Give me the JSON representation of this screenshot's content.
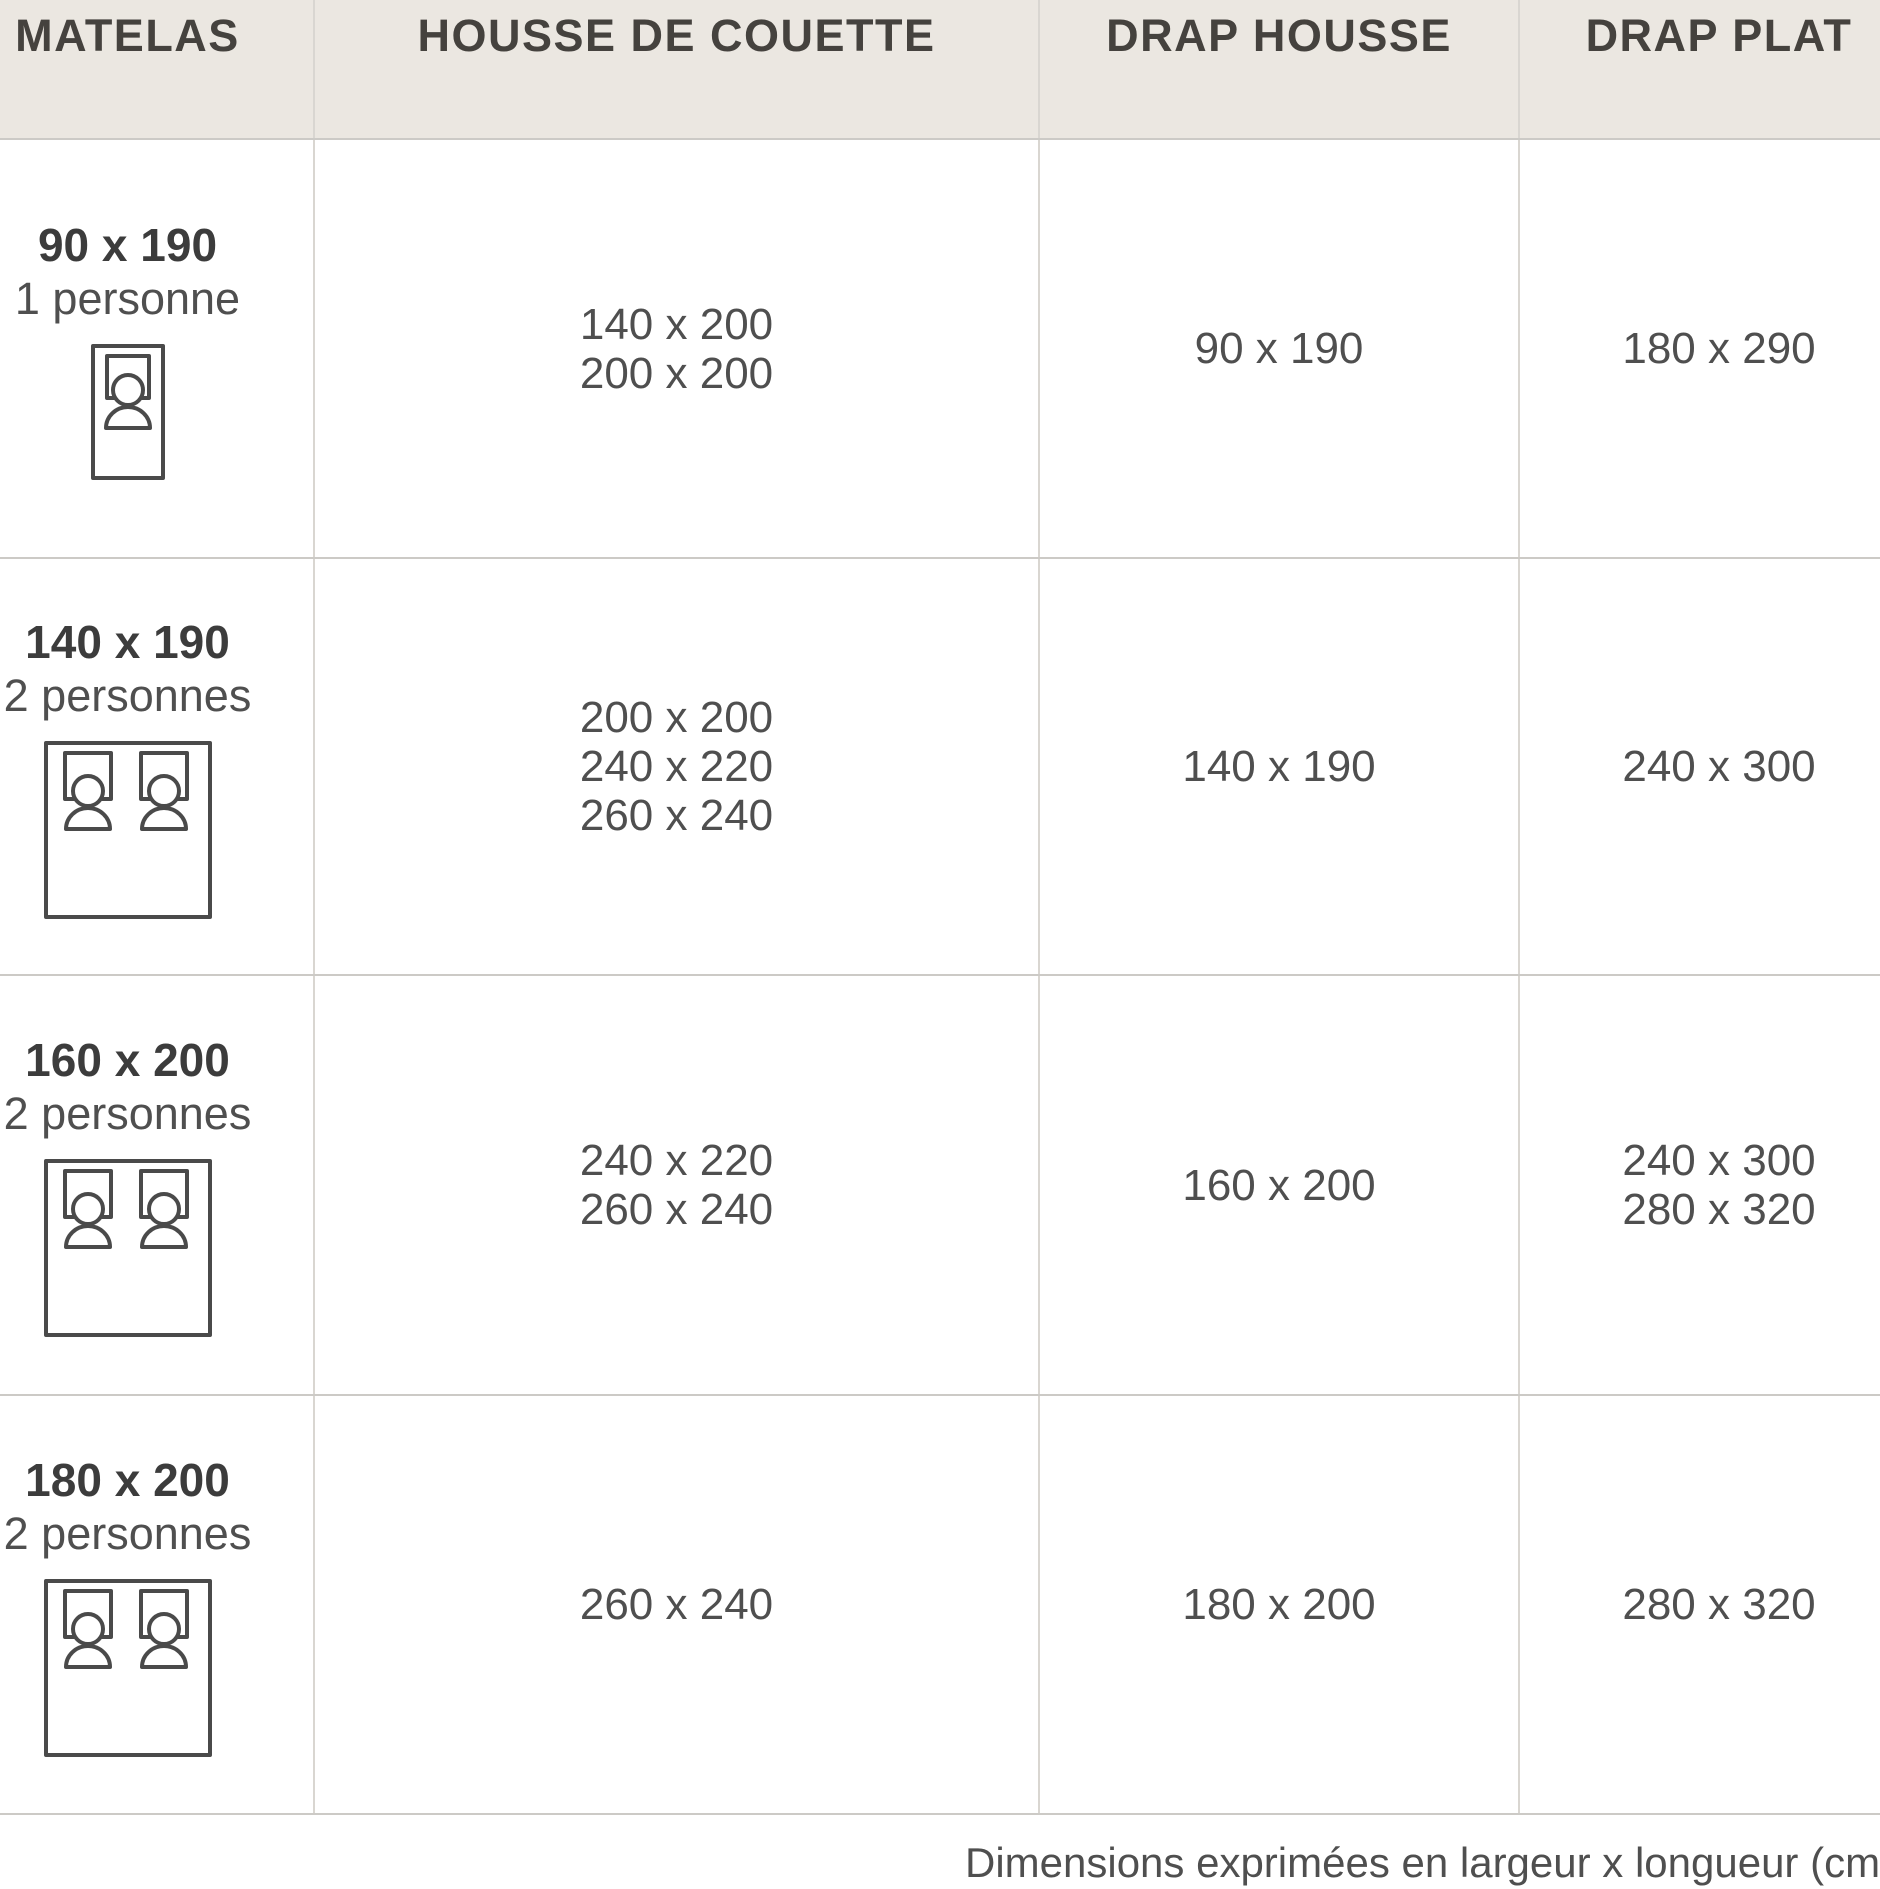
{
  "table": {
    "headers": [
      {
        "label": "MATELAS"
      },
      {
        "label": "HOUSSE DE COUETTE"
      },
      {
        "label": "DRAP HOUSSE"
      },
      {
        "label": "DRAP PLAT"
      }
    ],
    "rows": [
      {
        "matelas": {
          "size": "90 x 190",
          "persons": "1 personne",
          "icon": "single-bed"
        },
        "housse_de_couette": [
          "140 x 200",
          "200 x 200"
        ],
        "drap_housse": [
          "90 x 190"
        ],
        "drap_plat": [
          "180 x 290"
        ]
      },
      {
        "matelas": {
          "size": "140 x 190",
          "persons": "2 personnes",
          "icon": "double-bed"
        },
        "housse_de_couette": [
          "200 x 200",
          "240 x 220",
          "260 x 240"
        ],
        "drap_housse": [
          "140 x 190"
        ],
        "drap_plat": [
          "240 x 300"
        ]
      },
      {
        "matelas": {
          "size": "160 x 200",
          "persons": "2 personnes",
          "icon": "double-bed"
        },
        "housse_de_couette": [
          "240 x 220",
          "260 x 240"
        ],
        "drap_housse": [
          "160 x 200"
        ],
        "drap_plat": [
          "240 x 300",
          "280 x 320"
        ]
      },
      {
        "matelas": {
          "size": "180 x 200",
          "persons": "2 personnes",
          "icon": "double-bed"
        },
        "housse_de_couette": [
          "260 x 240"
        ],
        "drap_housse": [
          "180 x 200"
        ],
        "drap_plat": [
          "280 x 320"
        ]
      }
    ]
  },
  "footer": {
    "note": "Dimensions exprimées en largeur x longueur (cm"
  },
  "colors": {
    "header_bg": "#ebe7e1",
    "header_text": "#45423e",
    "body_text": "#4f4f4f",
    "title_text": "#3c3c3c",
    "grid_line": "#cccac6",
    "icon_stroke": "#4a4a4a"
  }
}
